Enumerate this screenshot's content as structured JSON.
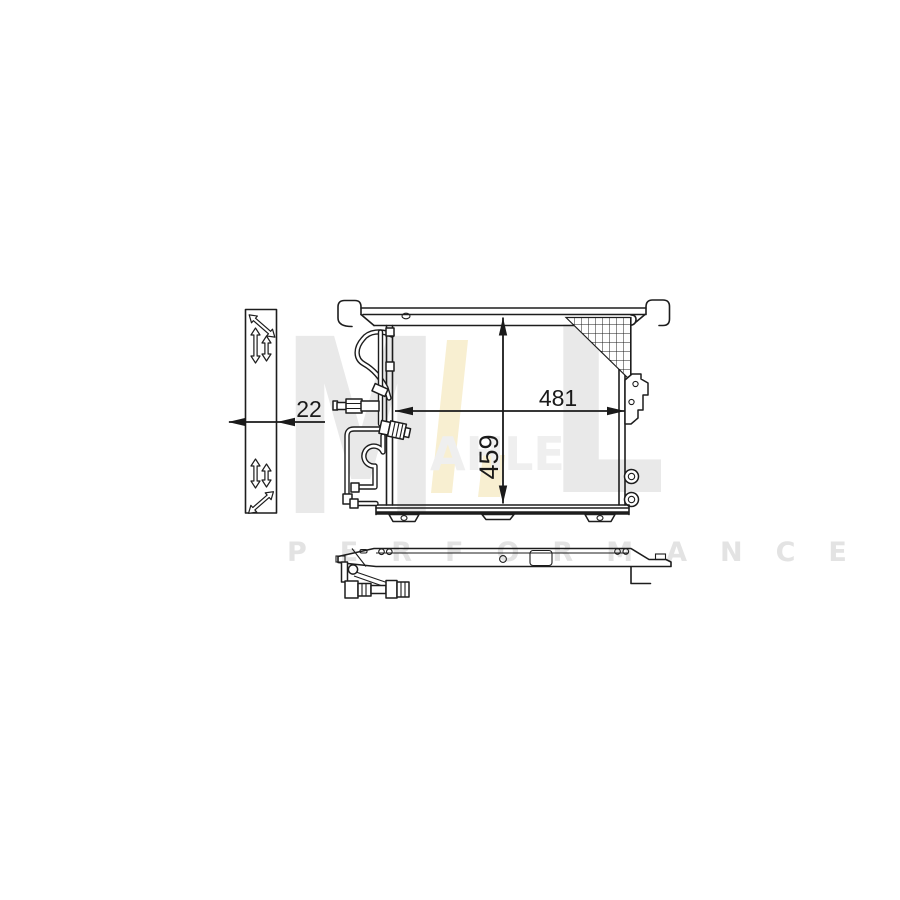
{
  "artwork": {
    "background": "#ffffff",
    "line_color": "#1d1d1d"
  },
  "dimensions": {
    "width": "481",
    "height": "459",
    "depth": "22"
  },
  "watermark": {
    "monogram_m": "M",
    "monogram_l": "L",
    "brand_letters": "AHLE",
    "tagline": "PERFORMANCE",
    "gray_color": "#e9e9e9",
    "faint_gray_color": "#efefef",
    "tagline_color": "#e3e3e3",
    "accent_yellow": "#f8efd1"
  }
}
